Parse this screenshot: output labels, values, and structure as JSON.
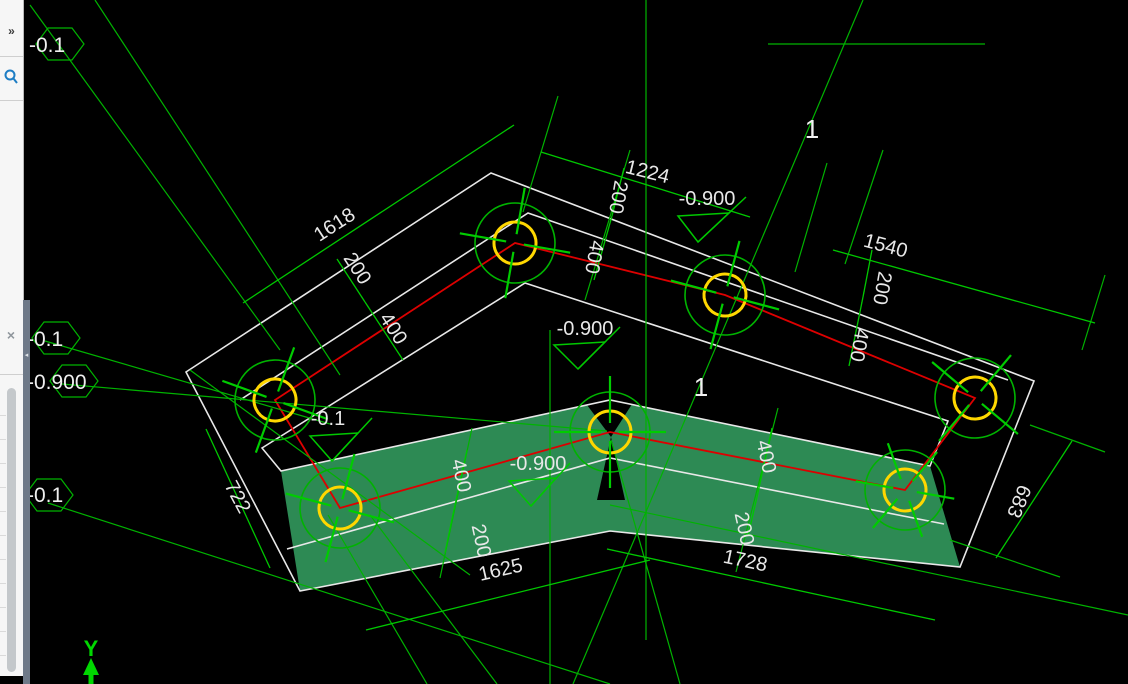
{
  "app": {
    "icons": {
      "collapse": "»",
      "close": "×",
      "splitter": "◂"
    }
  },
  "canvas": {
    "left_labels": [
      "-0.1",
      "-0.1",
      "-0.900",
      "-0.1"
    ],
    "elevations": [
      "-0.900",
      "-0.900",
      "-0.1",
      "-0.900"
    ],
    "dims": [
      "1224",
      "200",
      "400",
      "1540",
      "200",
      "400",
      "1618",
      "200",
      "400",
      "400",
      "200",
      "1625",
      "400",
      "200",
      "1728",
      "722",
      "683"
    ],
    "sections": [
      "1",
      "1"
    ],
    "axis": {
      "y": "Y"
    },
    "colors": {
      "construction_green": "#00b300",
      "dimension_green": "#00c800",
      "outline_white": "#e8e8e8",
      "centerline_red": "#dd0000",
      "pile_yellow": "#ffd700",
      "hatch_fill_green": "#2d8a54",
      "background": "#000000"
    }
  }
}
